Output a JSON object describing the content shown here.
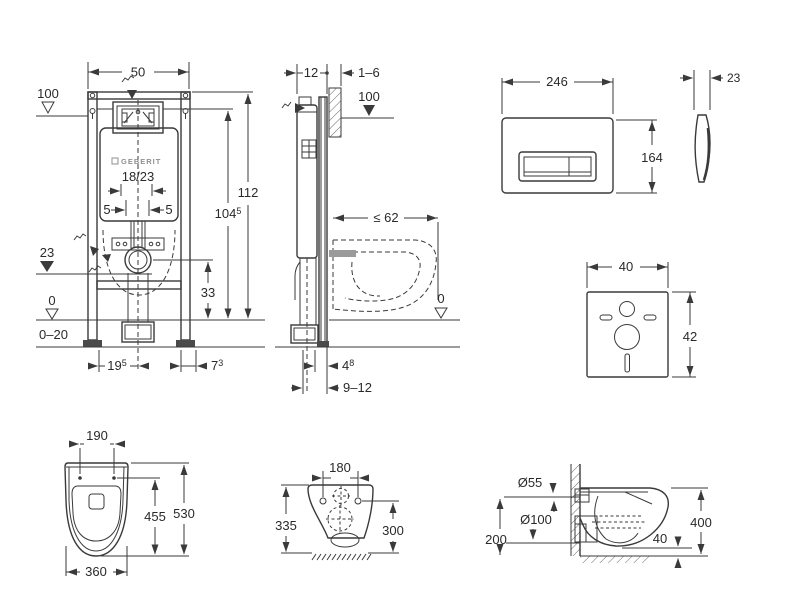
{
  "brand": "GEBERIT",
  "colors": {
    "background": "#ffffff",
    "line": "#3a3a3a",
    "text": "#2a2a2a",
    "muted": "#8f8f8f"
  },
  "frame_front": {
    "width": "50",
    "plate_level": "100",
    "flush_pipe": "18/23",
    "offset_left": "5",
    "offset_right": "5",
    "outlet_level": "23",
    "zero_level": "0",
    "floor_range": "0–20",
    "foot_left": {
      "val": "19",
      "sup": "5"
    },
    "foot_right": {
      "val": "7",
      "sup": "3"
    },
    "total_height": "112",
    "cistern_height": {
      "val": "104",
      "sup": "5"
    },
    "outlet_height": "33"
  },
  "frame_side": {
    "frame_depth": "12",
    "wall_thickness": "1–6",
    "plate_level": "100",
    "wc_depth": "≤ 62",
    "zero_level": "0",
    "pipe_offset": {
      "val": "4",
      "sup": "8"
    },
    "outlet_range": "9–12"
  },
  "flush_plate": {
    "width": "246",
    "height": "164",
    "depth": "23"
  },
  "sound_mat": {
    "width": "40",
    "height": "42"
  },
  "wc_top": {
    "hole_spacing": "190",
    "depth_inner": "455",
    "depth_total": "530",
    "width": "360"
  },
  "wc_rear": {
    "hole_spacing": "180",
    "height_left": "335",
    "height_right": "300"
  },
  "wc_side": {
    "flush_dia": "Ø55",
    "drain_dia": "Ø100",
    "drain_level": "200",
    "floor_gap": "40",
    "rim_height": "400"
  }
}
